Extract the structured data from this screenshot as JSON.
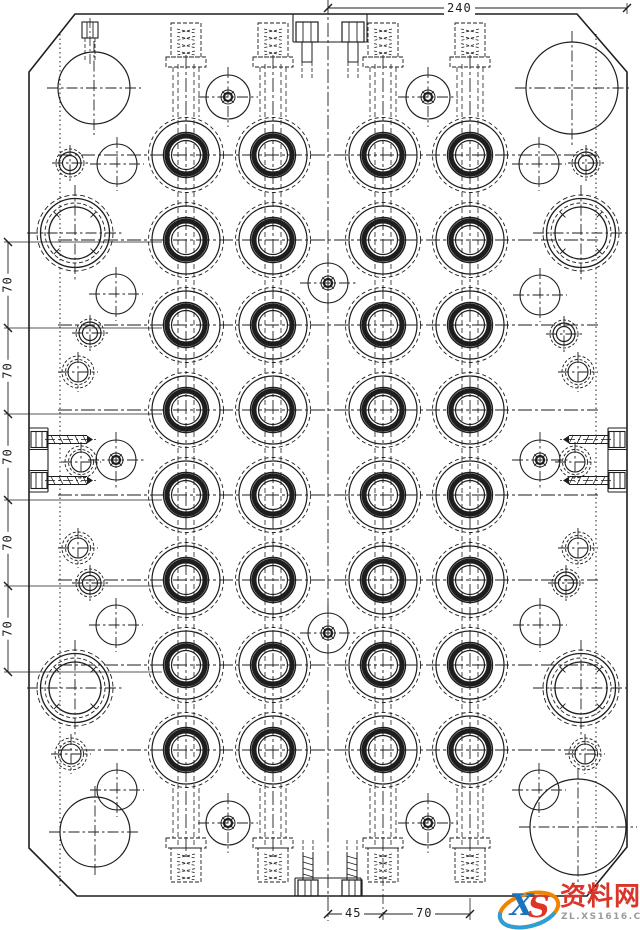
{
  "dimensions": {
    "top": {
      "label": "240"
    },
    "left": {
      "labels": [
        "70",
        "70",
        "70",
        "70",
        "70"
      ]
    },
    "bottom": {
      "labels": [
        "45",
        "70"
      ]
    }
  },
  "watermark": {
    "logo_x": "X",
    "logo_s": "S",
    "title": "资料网",
    "url": "ZL.XS1616.COM",
    "title_color": "#d9352a",
    "url_color": "#9b9b9b",
    "logo_blue": "#2b9fd6",
    "logo_orange": "#f08300"
  },
  "drawing": {
    "line_color": "#1e1e1e",
    "background": "#ffffff",
    "plate_points": "75,14 577,14 627,72 627,847 587,896 77,896 29,848 29,72",
    "center_x": 328,
    "dotted_lines_x": [
      60,
      596
    ],
    "row_centers_y": [
      155,
      240,
      325,
      410,
      495,
      580,
      665,
      750
    ],
    "row_line_x": [
      58,
      598
    ],
    "cavity_columns_x": [
      186,
      273,
      383,
      470
    ],
    "cavity_radii": {
      "dashed": 37.5,
      "outer": 34,
      "ring_outer": 22.5,
      "ring": 19,
      "ring_stroke": 5,
      "inner": 14.5
    },
    "guide_bushings": [
      [
        75,
        233
      ],
      [
        581,
        233
      ],
      [
        75,
        688
      ],
      [
        581,
        688
      ]
    ],
    "guide_bushing_radii": [
      38,
      34.5,
      30,
      26
    ],
    "corner_circles": [
      [
        94,
        88,
        36
      ],
      [
        572,
        88,
        46
      ],
      [
        95,
        832,
        35
      ],
      [
        578,
        827,
        48
      ]
    ],
    "bolt_circles": [
      [
        228,
        97,
        22
      ],
      [
        428,
        97,
        22
      ],
      [
        228,
        823,
        22
      ],
      [
        428,
        823,
        22
      ],
      [
        328,
        283,
        20
      ],
      [
        328,
        633,
        20
      ],
      [
        116,
        460,
        20
      ],
      [
        540,
        460,
        20
      ]
    ],
    "plain_circles": [
      [
        117,
        164,
        20
      ],
      [
        116,
        294,
        20
      ],
      [
        116,
        625,
        20
      ],
      [
        117,
        790,
        20
      ],
      [
        539,
        164,
        20
      ],
      [
        540,
        295,
        20
      ],
      [
        540,
        625,
        20
      ],
      [
        539,
        790,
        20
      ]
    ],
    "small_bushings": [
      [
        70,
        163
      ],
      [
        90,
        333
      ],
      [
        90,
        583
      ],
      [
        586,
        163
      ],
      [
        564,
        334
      ],
      [
        566,
        583
      ]
    ],
    "tapped_holes": [
      [
        78,
        372
      ],
      [
        81,
        462
      ],
      [
        78,
        548
      ],
      [
        71,
        754
      ],
      [
        578,
        372
      ],
      [
        575,
        462
      ],
      [
        578,
        548
      ],
      [
        585,
        754
      ]
    ],
    "top_edge_bolt_x": [
      90
    ],
    "dim_top": {
      "y": 8,
      "x1": 328,
      "x2": 627,
      "label_cx": 462
    },
    "dim_left": {
      "x": 8,
      "ticks_y": [
        242,
        328,
        414,
        500,
        586,
        672
      ],
      "ext_x2": 162
    },
    "dim_bottom": {
      "y": 914,
      "ticks_x": [
        328,
        383,
        470
      ]
    }
  }
}
